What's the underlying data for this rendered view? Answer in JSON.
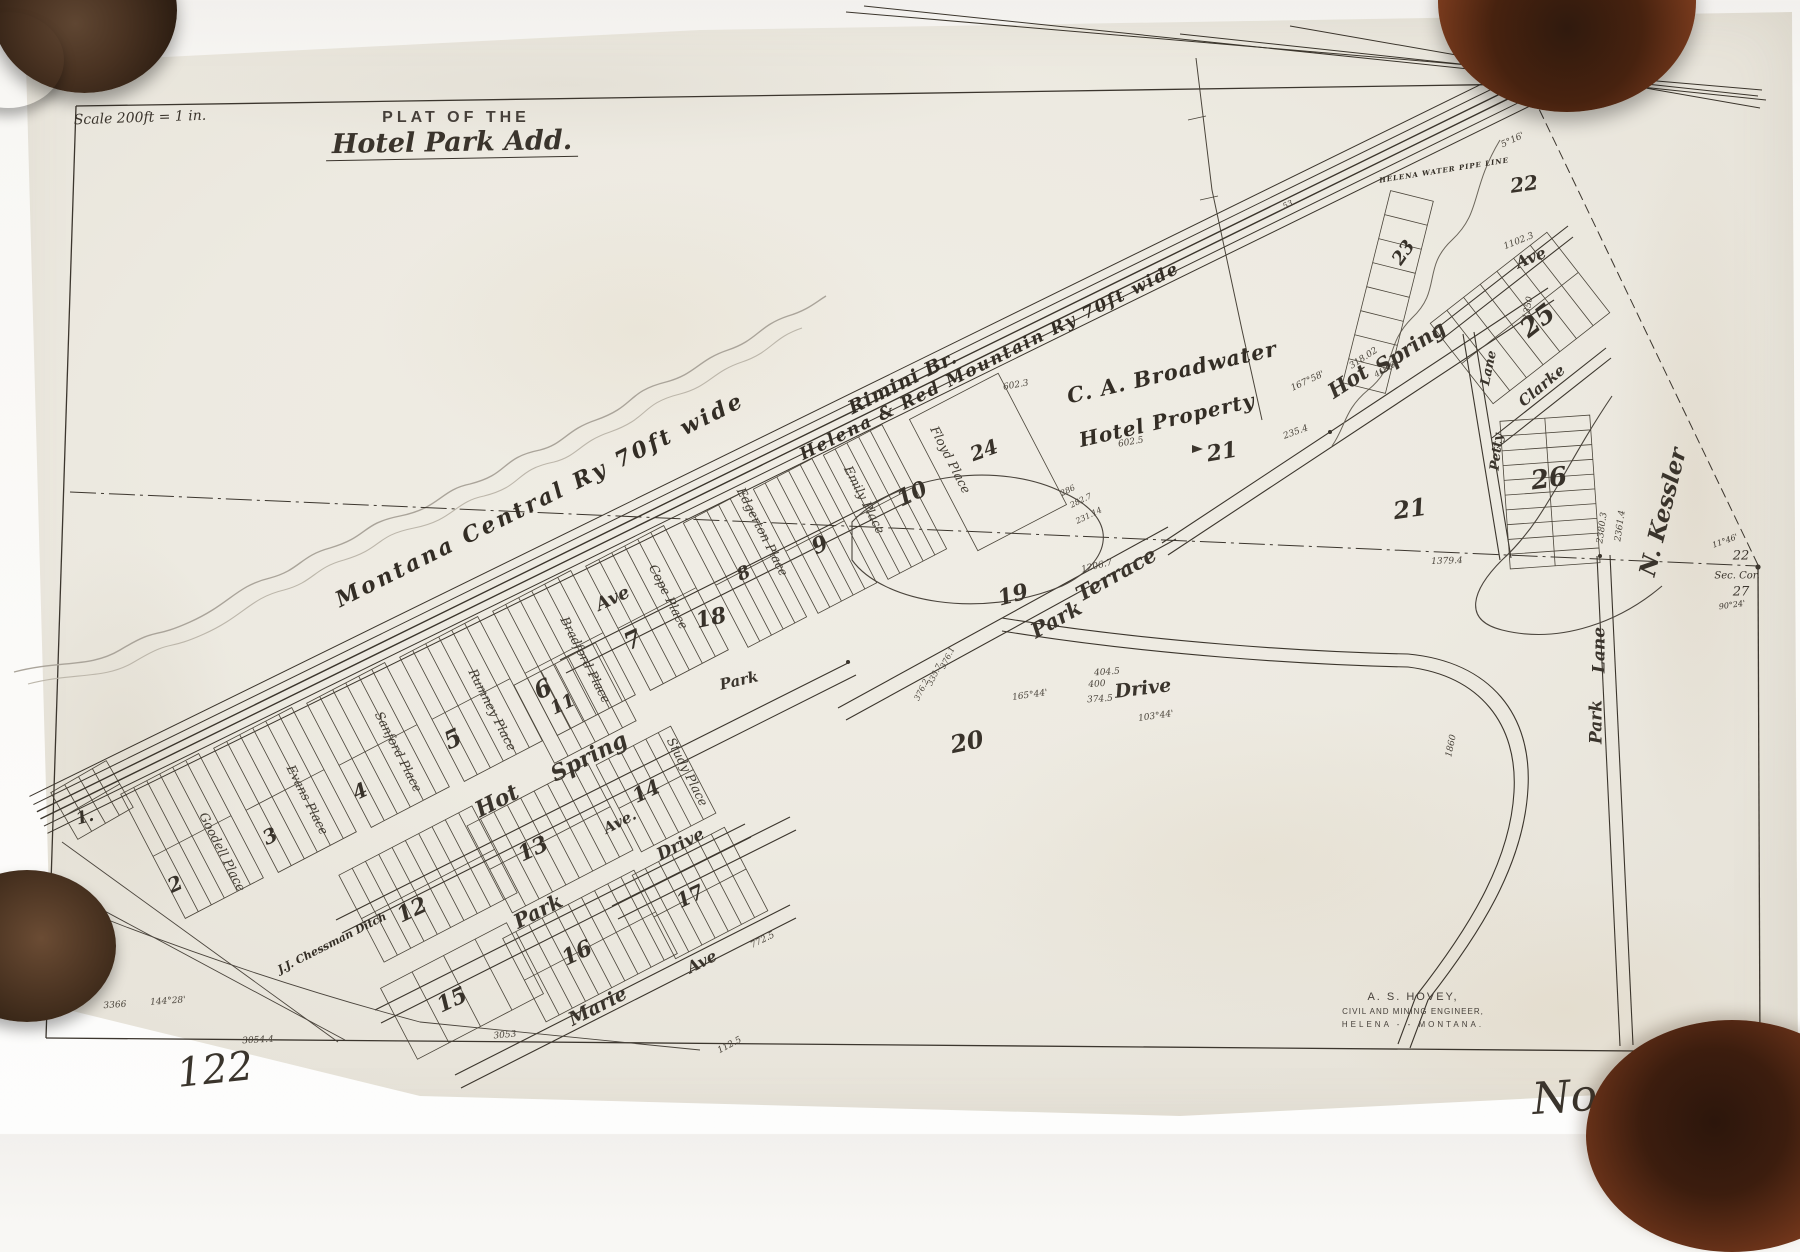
{
  "colors": {
    "ink": "#3a342c",
    "pencil": "#a8a296",
    "paper": "#edeae1",
    "backdrop": "#f8f7f4",
    "leather_dark": "#2f1a0e",
    "leather_red": "#7c3b1e"
  },
  "title_block": {
    "plat_label": "PLAT OF THE",
    "addition_name": "Hotel Park Add.",
    "scale_note": "Scale 200ft = 1 in."
  },
  "sheet_numbers": {
    "bottom_left": "122",
    "bottom_right": "No. 122"
  },
  "surveyor_stamp": {
    "name": "A. S. HOVEY,",
    "title": "CIVIL AND MINING ENGINEER,",
    "location": "HELENA  -  -  MONTANA."
  },
  "section_corner": {
    "block_ref": "22",
    "label": "Sec. Cor.",
    "number": "27",
    "angle_top": "11°46'",
    "angle_bottom": "90°24'"
  },
  "railroad_labels": [
    {
      "t": "Montana Central Ry 70ft wide",
      "x": 540,
      "y": 500,
      "r": -26.5,
      "fs": 22,
      "ls": 3
    },
    {
      "t": "Rimini Br.",
      "x": 903,
      "y": 383,
      "r": -26.5,
      "fs": 19,
      "ls": 1
    },
    {
      "t": "Helena & Red Mountain Ry 70ft wide",
      "x": 990,
      "y": 362,
      "r": -26.5,
      "fs": 17,
      "ls": 2
    },
    {
      "t": "HELENA WATER PIPE LINE",
      "x": 1444,
      "y": 170,
      "r": -9,
      "fs": 7,
      "ls": 1
    }
  ],
  "property_labels": [
    {
      "t": "C. A. Broadwater",
      "x": 1172,
      "y": 372,
      "r": -13,
      "fs": 21,
      "ls": 1
    },
    {
      "t": "Hotel Property",
      "x": 1167,
      "y": 420,
      "r": -13,
      "fs": 20,
      "ls": 1
    },
    {
      "t": "J.J. Chessman Ditch",
      "x": 332,
      "y": 943,
      "r": -27,
      "fs": 11,
      "ls": 0
    }
  ],
  "street_labels": [
    {
      "t": "Hot",
      "x": 497,
      "y": 801,
      "r": -27,
      "fs": 22
    },
    {
      "t": "Spring",
      "x": 589,
      "y": 757,
      "r": -27,
      "fs": 22
    },
    {
      "t": "Ave",
      "x": 613,
      "y": 599,
      "r": -25,
      "fs": 18
    },
    {
      "t": "Park",
      "x": 538,
      "y": 911,
      "r": -27,
      "fs": 20
    },
    {
      "t": "Ave.",
      "x": 620,
      "y": 822,
      "r": -27,
      "fs": 15
    },
    {
      "t": "Drive",
      "x": 681,
      "y": 845,
      "r": -27,
      "fs": 17
    },
    {
      "t": "Marie",
      "x": 598,
      "y": 1007,
      "r": -27,
      "fs": 19
    },
    {
      "t": "Ave",
      "x": 702,
      "y": 962,
      "r": -27,
      "fs": 16
    },
    {
      "t": "Park",
      "x": 739,
      "y": 681,
      "r": -13,
      "fs": 15
    },
    {
      "t": "Park",
      "x": 1056,
      "y": 619,
      "r": -29,
      "fs": 21
    },
    {
      "t": "Terrace",
      "x": 1116,
      "y": 574,
      "r": -29,
      "fs": 21
    },
    {
      "t": "Drive",
      "x": 1143,
      "y": 689,
      "r": -7,
      "fs": 19
    },
    {
      "t": "Hot",
      "x": 1348,
      "y": 381,
      "r": -33,
      "fs": 21
    },
    {
      "t": "Spring",
      "x": 1410,
      "y": 347,
      "r": -33,
      "fs": 21
    },
    {
      "t": "Lane",
      "x": 1600,
      "y": 650,
      "r": -90,
      "fs": 17
    },
    {
      "t": "Park",
      "x": 1597,
      "y": 722,
      "r": -90,
      "fs": 17
    },
    {
      "t": "Ave",
      "x": 1531,
      "y": 258,
      "r": -22,
      "fs": 16
    },
    {
      "t": "Clarke",
      "x": 1542,
      "y": 386,
      "r": -40,
      "fs": 15
    },
    {
      "t": "Lane",
      "x": 1489,
      "y": 368,
      "r": -78,
      "fs": 13
    },
    {
      "t": "Petty",
      "x": 1497,
      "y": 452,
      "r": -84,
      "fs": 13
    },
    {
      "t": "N. Kessler",
      "x": 1663,
      "y": 512,
      "r": -76,
      "fs": 23
    }
  ],
  "place_labels": [
    {
      "t": "Goodell Place",
      "x": 222,
      "y": 852,
      "r": 63,
      "fs": 12.5
    },
    {
      "t": "Evans Place",
      "x": 307,
      "y": 800,
      "r": 63,
      "fs": 12.5
    },
    {
      "t": "Sanford Place",
      "x": 398,
      "y": 752,
      "r": 63,
      "fs": 12.5
    },
    {
      "t": "Rumney Place",
      "x": 492,
      "y": 710,
      "r": 63,
      "fs": 12.5
    },
    {
      "t": "Bradford Place",
      "x": 585,
      "y": 660,
      "r": 63,
      "fs": 12.5
    },
    {
      "t": "Cope Place",
      "x": 668,
      "y": 597,
      "r": 63,
      "fs": 12.5
    },
    {
      "t": "Edgerton Place",
      "x": 762,
      "y": 532,
      "r": 63,
      "fs": 12.5
    },
    {
      "t": "Emily Place",
      "x": 864,
      "y": 500,
      "r": 63,
      "fs": 12.5
    },
    {
      "t": "Floyd Place",
      "x": 950,
      "y": 460,
      "r": 63,
      "fs": 12.5
    },
    {
      "t": "Study Place",
      "x": 687,
      "y": 772,
      "r": 63,
      "fs": 12.5
    }
  ],
  "block_numbers": [
    {
      "t": "1.",
      "x": 85,
      "y": 818,
      "r": -15,
      "fs": 17
    },
    {
      "t": "2",
      "x": 175,
      "y": 884,
      "r": -25,
      "fs": 20
    },
    {
      "t": "3",
      "x": 270,
      "y": 836,
      "r": -25,
      "fs": 20
    },
    {
      "t": "4",
      "x": 360,
      "y": 791,
      "r": -25,
      "fs": 20
    },
    {
      "t": "5",
      "x": 453,
      "y": 739,
      "r": -25,
      "fs": 24
    },
    {
      "t": "6",
      "x": 543,
      "y": 689,
      "r": -25,
      "fs": 24
    },
    {
      "t": "7",
      "x": 633,
      "y": 640,
      "r": -25,
      "fs": 24
    },
    {
      "t": "8",
      "x": 744,
      "y": 574,
      "r": -25,
      "fs": 18
    },
    {
      "t": "9",
      "x": 820,
      "y": 545,
      "r": -25,
      "fs": 22
    },
    {
      "t": "10",
      "x": 912,
      "y": 494,
      "r": -25,
      "fs": 22
    },
    {
      "t": "11",
      "x": 563,
      "y": 705,
      "r": -25,
      "fs": 18
    },
    {
      "t": "12",
      "x": 412,
      "y": 910,
      "r": -25,
      "fs": 22
    },
    {
      "t": "13",
      "x": 533,
      "y": 849,
      "r": -25,
      "fs": 22
    },
    {
      "t": "14",
      "x": 646,
      "y": 791,
      "r": -25,
      "fs": 20
    },
    {
      "t": "15",
      "x": 452,
      "y": 1000,
      "r": -25,
      "fs": 22
    },
    {
      "t": "16",
      "x": 577,
      "y": 953,
      "r": -25,
      "fs": 22
    },
    {
      "t": "17",
      "x": 690,
      "y": 896,
      "r": -25,
      "fs": 20
    },
    {
      "t": "18",
      "x": 711,
      "y": 618,
      "r": -12,
      "fs": 22
    },
    {
      "t": "19",
      "x": 1013,
      "y": 595,
      "r": -15,
      "fs": 22
    },
    {
      "t": "20",
      "x": 967,
      "y": 742,
      "r": -12,
      "fs": 24
    },
    {
      "t": "21",
      "x": 1222,
      "y": 452,
      "r": -10,
      "fs": 22
    },
    {
      "t": "21",
      "x": 1410,
      "y": 509,
      "r": -8,
      "fs": 24
    },
    {
      "t": "22",
      "x": 1524,
      "y": 184,
      "r": -8,
      "fs": 20
    },
    {
      "t": "23",
      "x": 1404,
      "y": 253,
      "r": -55,
      "fs": 18
    },
    {
      "t": "24",
      "x": 984,
      "y": 450,
      "r": -20,
      "fs": 20
    },
    {
      "t": "25",
      "x": 1538,
      "y": 321,
      "r": -38,
      "fs": 26
    },
    {
      "t": "26",
      "x": 1549,
      "y": 479,
      "r": -8,
      "fs": 26
    }
  ],
  "measurements": [
    {
      "t": "1379.4",
      "x": 1447,
      "y": 562,
      "r": -2,
      "fs": 9
    },
    {
      "t": "1102.3",
      "x": 1519,
      "y": 242,
      "r": -22,
      "fs": 9
    },
    {
      "t": "2380.3",
      "x": 1603,
      "y": 528,
      "r": -82,
      "fs": 9
    },
    {
      "t": "2361.4",
      "x": 1621,
      "y": 526,
      "r": -82,
      "fs": 9
    },
    {
      "t": "3366",
      "x": 115,
      "y": 1006,
      "r": -4,
      "fs": 9
    },
    {
      "t": "144°28'",
      "x": 168,
      "y": 1002,
      "r": -4,
      "fs": 9
    },
    {
      "t": "3054.4",
      "x": 258,
      "y": 1041,
      "r": -3,
      "fs": 9
    },
    {
      "t": "3053",
      "x": 505,
      "y": 1036,
      "r": -5,
      "fs": 9
    },
    {
      "t": "112.5",
      "x": 730,
      "y": 1046,
      "r": -28,
      "fs": 9
    },
    {
      "t": "772.5",
      "x": 763,
      "y": 941,
      "r": -27,
      "fs": 9
    },
    {
      "t": "495",
      "x": 1674,
      "y": 1049,
      "r": 0,
      "fs": 9
    },
    {
      "t": "318.02",
      "x": 1364,
      "y": 359,
      "r": -33,
      "fs": 9
    },
    {
      "t": "419.6",
      "x": 1385,
      "y": 370,
      "r": -30,
      "fs": 8
    },
    {
      "t": "167°58'",
      "x": 1308,
      "y": 382,
      "r": -25,
      "fs": 9
    },
    {
      "t": "235.4",
      "x": 1296,
      "y": 433,
      "r": -20,
      "fs": 9
    },
    {
      "t": "602.3",
      "x": 1016,
      "y": 386,
      "r": -10,
      "fs": 9
    },
    {
      "t": "602.5",
      "x": 1131,
      "y": 443,
      "r": -10,
      "fs": 9
    },
    {
      "t": "286",
      "x": 1068,
      "y": 491,
      "r": -26,
      "fs": 8
    },
    {
      "t": "282.7",
      "x": 1081,
      "y": 501,
      "r": -26,
      "fs": 8
    },
    {
      "t": "231.14",
      "x": 1089,
      "y": 516,
      "r": -26,
      "fs": 8
    },
    {
      "t": "1206.7",
      "x": 1097,
      "y": 567,
      "r": -14,
      "fs": 9
    },
    {
      "t": "404.5",
      "x": 1107,
      "y": 673,
      "r": -4,
      "fs": 9
    },
    {
      "t": "400",
      "x": 1097,
      "y": 685,
      "r": -4,
      "fs": 9
    },
    {
      "t": "374.5",
      "x": 1100,
      "y": 700,
      "r": -4,
      "fs": 9
    },
    {
      "t": "103°44'",
      "x": 1156,
      "y": 717,
      "r": -8,
      "fs": 9
    },
    {
      "t": "165°44'",
      "x": 1030,
      "y": 696,
      "r": -8,
      "fs": 9
    },
    {
      "t": "335.7",
      "x": 935,
      "y": 675,
      "r": -64,
      "fs": 8
    },
    {
      "t": "376.1",
      "x": 948,
      "y": 658,
      "r": -64,
      "fs": 8
    },
    {
      "t": "376.2",
      "x": 922,
      "y": 690,
      "r": -64,
      "fs": 8
    },
    {
      "t": "5°16'",
      "x": 1513,
      "y": 141,
      "r": -25,
      "fs": 9
    },
    {
      "t": "1350",
      "x": 1529,
      "y": 308,
      "r": -80,
      "fs": 9
    },
    {
      "t": "1860",
      "x": 1452,
      "y": 746,
      "r": -78,
      "fs": 9
    },
    {
      "t": "53",
      "x": 1288,
      "y": 205,
      "r": -25,
      "fs": 8
    }
  ]
}
